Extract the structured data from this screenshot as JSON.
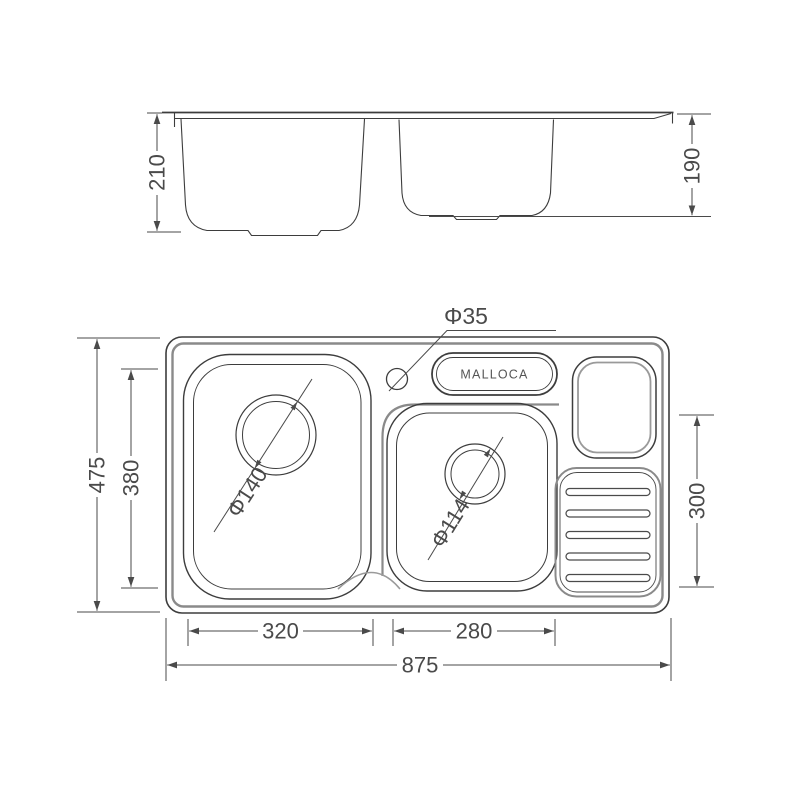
{
  "diagram": {
    "brand": "MALLOCA",
    "side_view": {
      "left_bowl_depth": "210",
      "right_bowl_depth": "190"
    },
    "plan_view": {
      "faucet_hole_diameter": "Φ35",
      "left_drain_diameter": "Φ140",
      "right_drain_diameter": "Φ114",
      "overall_width": "475",
      "left_bowl_inner_width": "380",
      "right_section_height": "300",
      "left_bowl_length": "320",
      "right_bowl_length": "280",
      "overall_length": "875"
    },
    "colors": {
      "object_line": "#3d3d3d",
      "pressed_line": "#8a8a8a",
      "dimension_line": "#4a4a4a"
    }
  }
}
